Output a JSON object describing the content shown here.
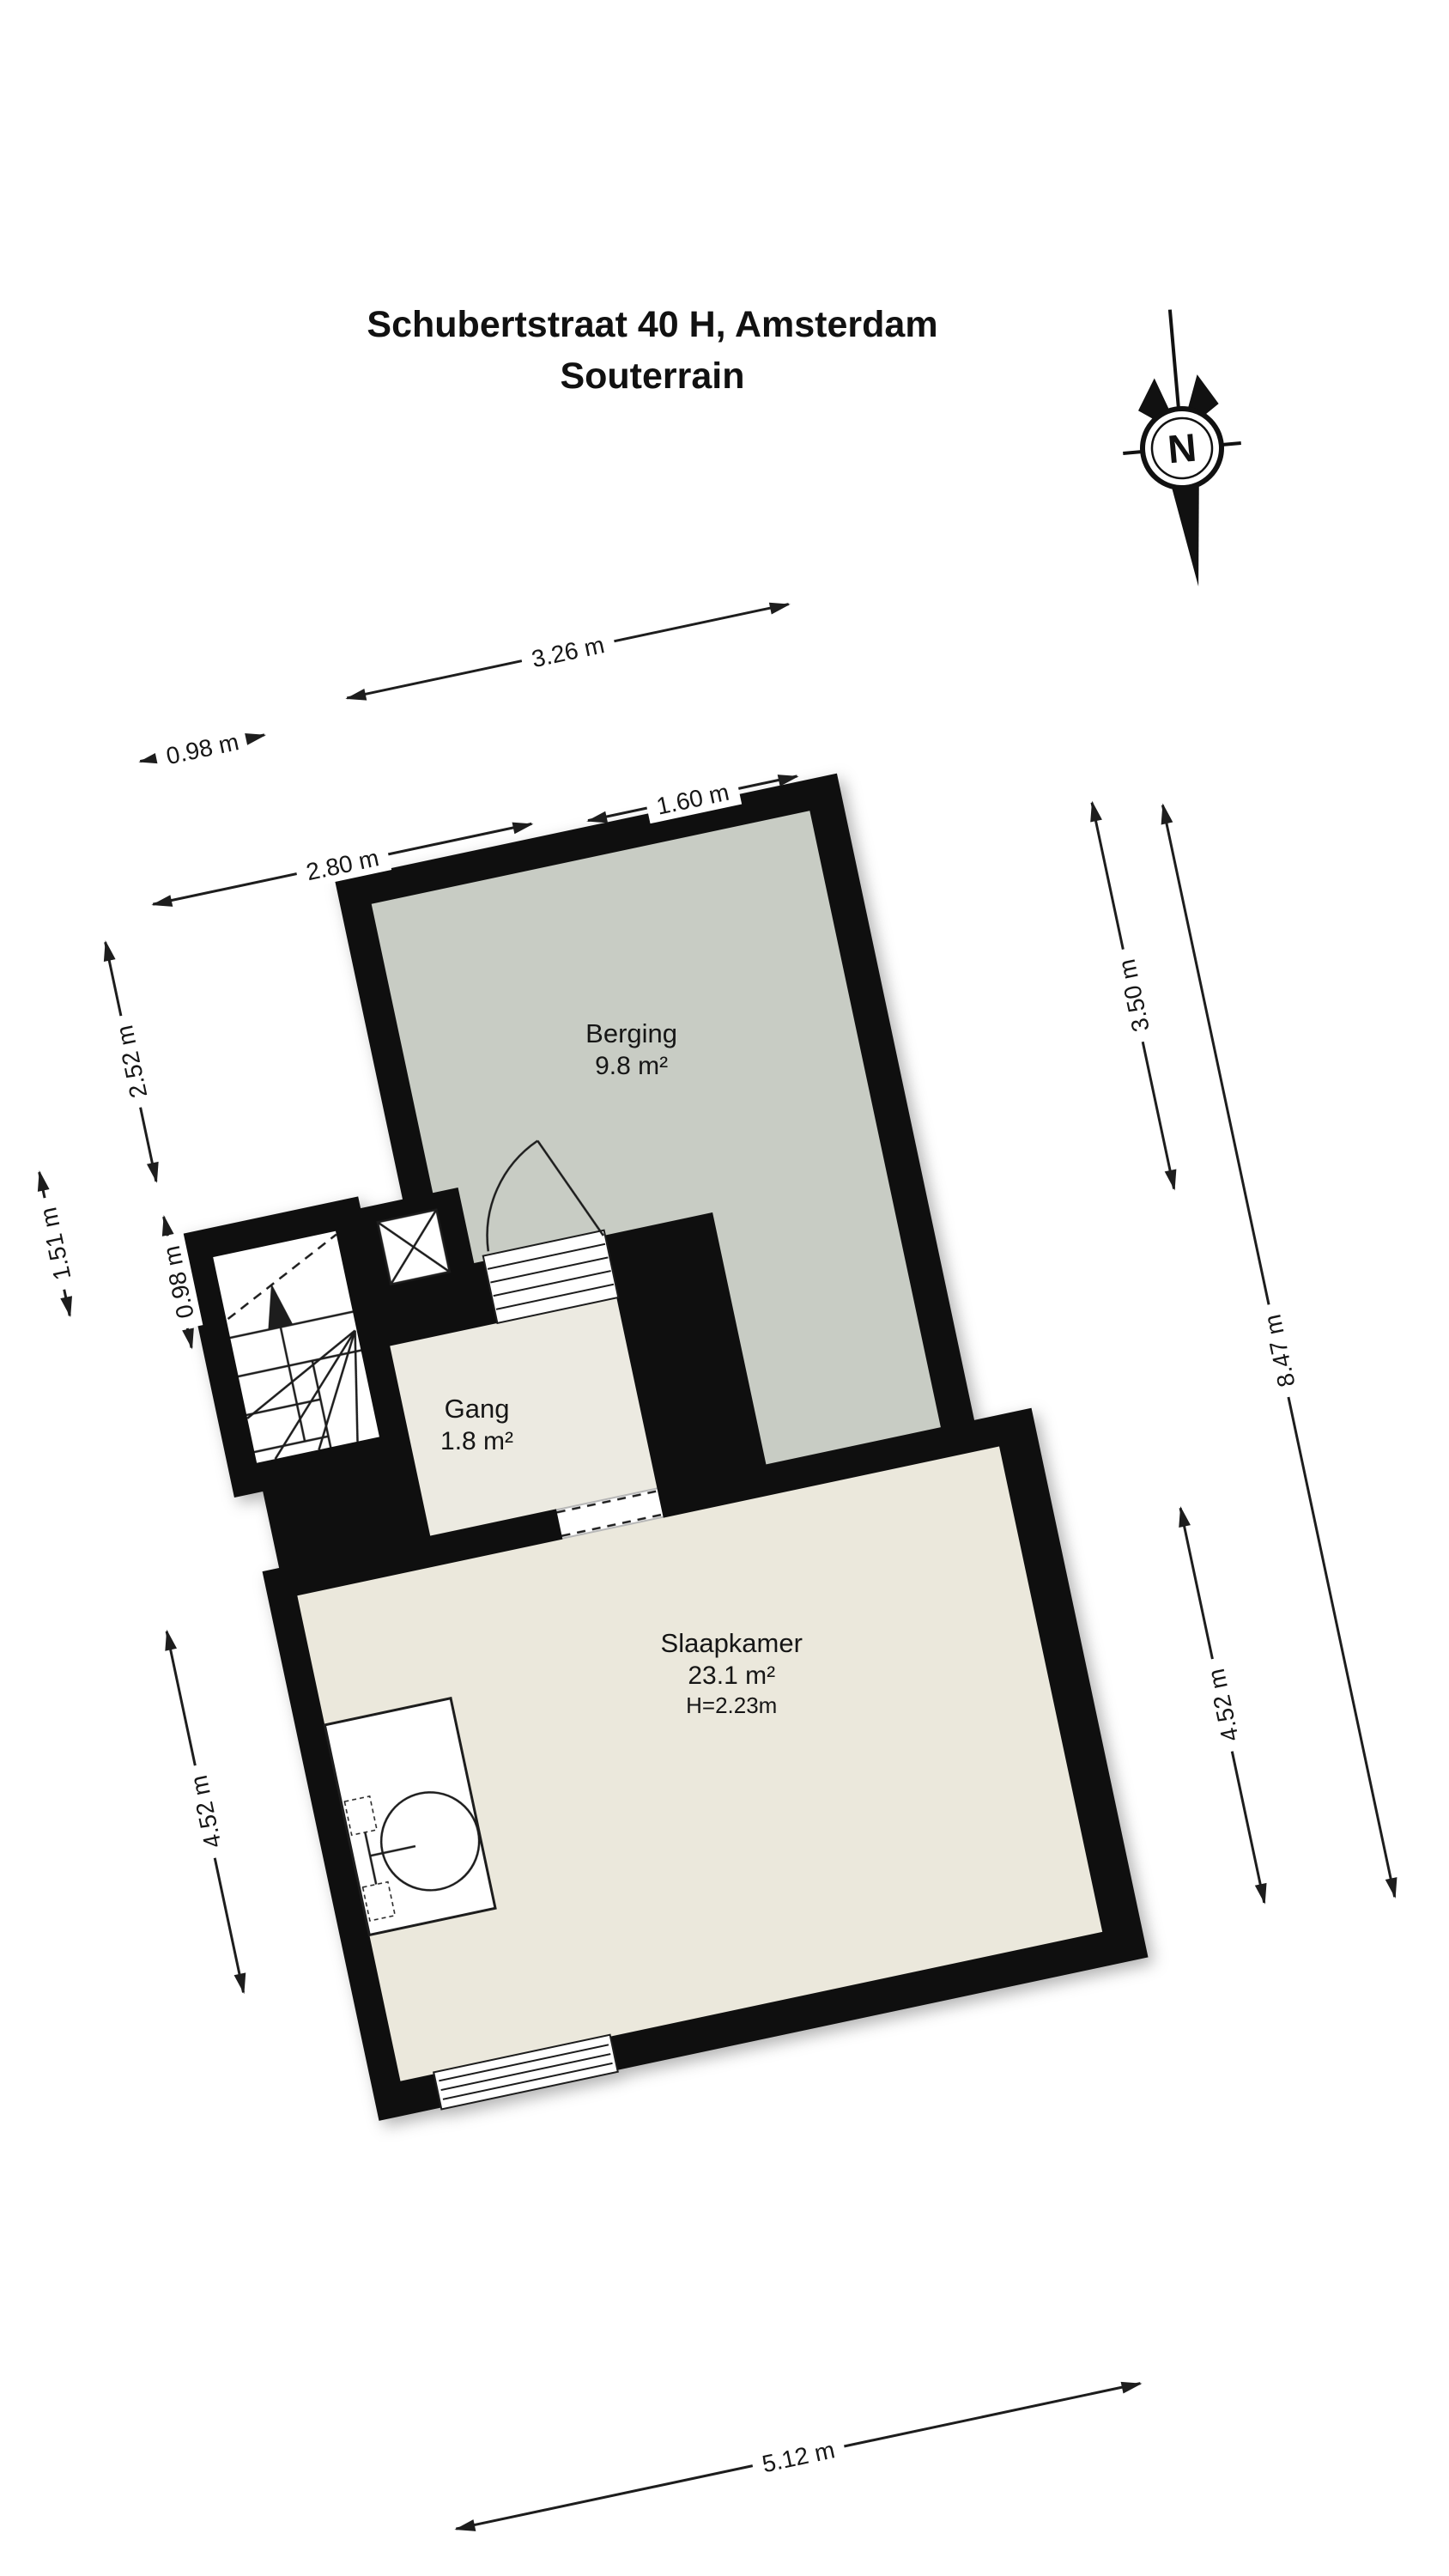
{
  "title": {
    "line1": "Schubertstraat 40 H, Amsterdam",
    "line2": "Souterrain"
  },
  "compass": {
    "label": "N"
  },
  "rooms": {
    "berging": {
      "name": "Berging",
      "area": "9.8 m²"
    },
    "gang": {
      "name": "Gang",
      "area": "1.8 m²"
    },
    "slaapkamer": {
      "name": "Slaapkamer",
      "area": "23.1 m²",
      "height": "H=2.23m"
    }
  },
  "dimensions": {
    "top_326": "3.26 m",
    "top_098": "0.98 m",
    "top_160": "1.60 m",
    "top_280": "2.80 m",
    "left_252": "2.52 m",
    "left_151": "1.51 m",
    "left_098": "0.98 m",
    "left_452": "4.52 m",
    "right_350": "3.50 m",
    "right_452": "4.52 m",
    "right_847": "8.47 m",
    "bottom_512": "5.12 m"
  },
  "colors": {
    "wall": "#0f0f0f",
    "line": "#1d1d1d",
    "berging": "#c8ccc4",
    "gang": "#eceae1",
    "slaap": "#ebe8dc",
    "bg": "#ffffff",
    "text": "#161616"
  }
}
